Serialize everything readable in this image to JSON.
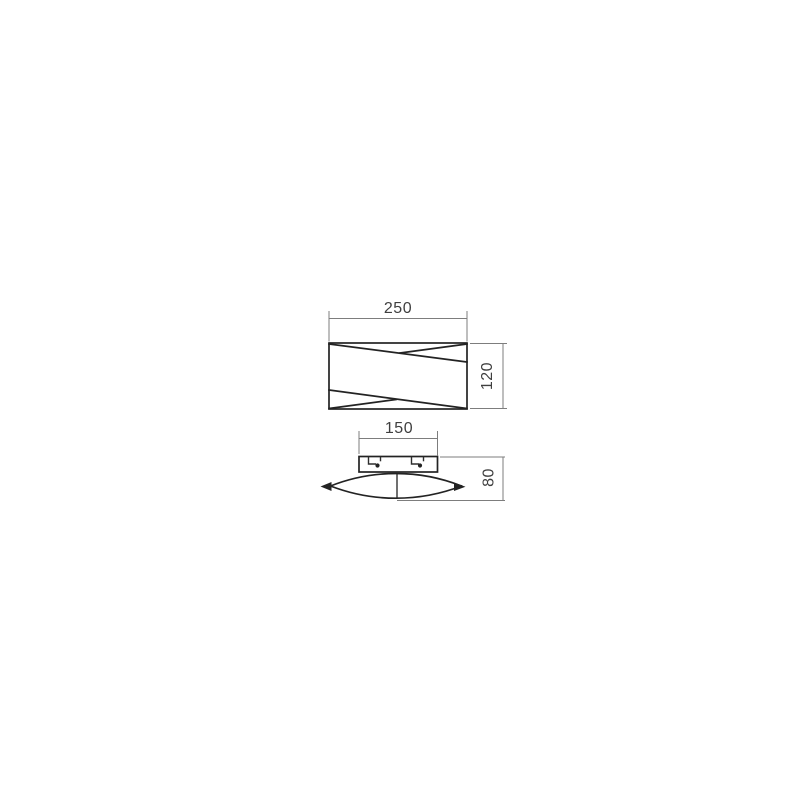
{
  "canvas": {
    "background_color": "#ffffff"
  },
  "colors": {
    "object_line": "#232323",
    "detail_line": "#2e2e2e",
    "dimension_line": "#7d7d7d",
    "dimension_text": "#3f3f3f"
  },
  "dimensions": {
    "front_width": "250",
    "front_height": "120",
    "top_plate_width": "150",
    "top_depth": "80"
  }
}
